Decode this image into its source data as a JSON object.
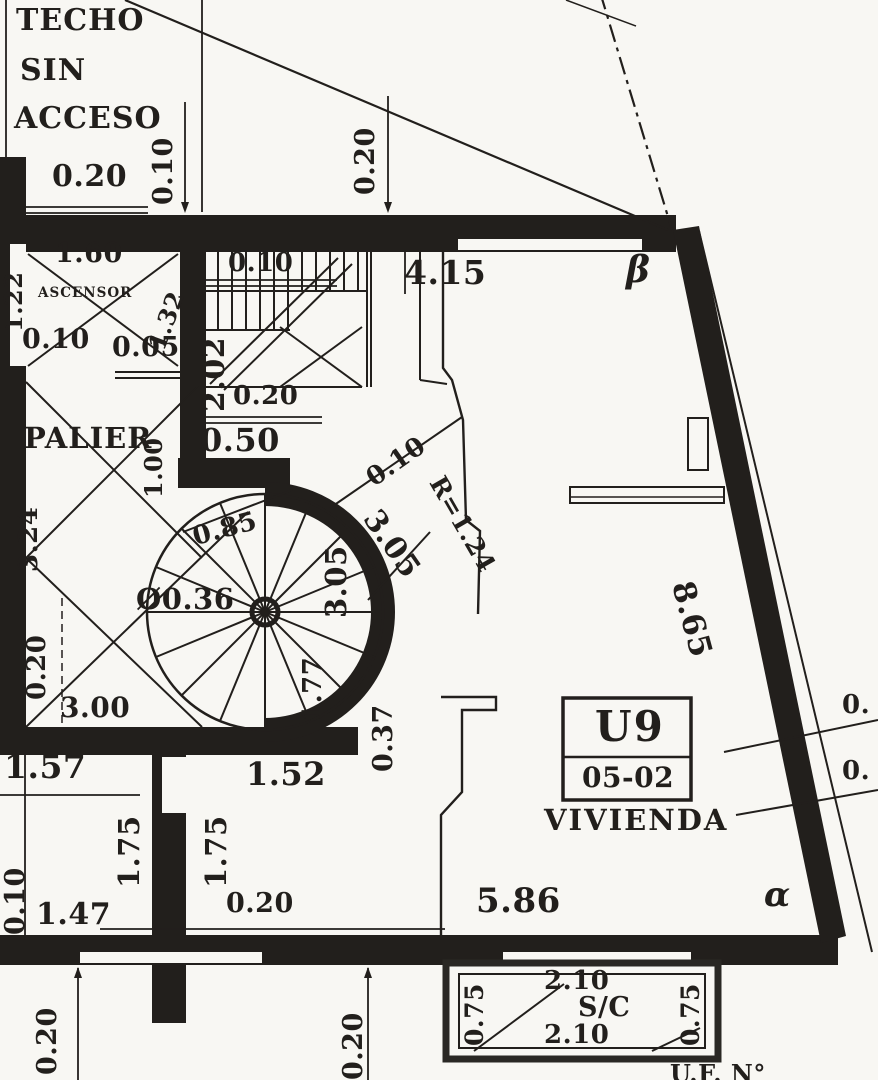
{
  "colors": {
    "ink": "#221f1c",
    "paper": "#f8f7f3"
  },
  "texts": {
    "techo_1": "TECHO",
    "techo_2": "SIN",
    "techo_3": "ACCESO",
    "ascensor": "ASCENSOR",
    "palier": "PALIER",
    "vivienda": "VIVIENDA",
    "sc": "S/C",
    "unit": "U9",
    "unit_code": "05-02",
    "alpha": "α",
    "beta": "β",
    "uf_partial": "U.F. N°"
  },
  "dims": {
    "roof_020": "0.20",
    "roof_010": "0.10",
    "top_020": "0.20",
    "top_415": "4.15",
    "elev_160": "1.60",
    "elev_122": "1.22",
    "elev_132": "1.32",
    "elev_010": "0.10",
    "elev_005": "0.05",
    "stair_202": "2.02",
    "stair_010": "0.10",
    "stair_020": "0.20",
    "stair_050": "0.50",
    "palier_100": "1.00",
    "palier_324": "3.24",
    "palier_020": "0.20",
    "palier_300": "3.00",
    "spiral_085": "0.85",
    "spiral_dia": "Ø0.36",
    "spiral_305a": "3.05",
    "spiral_305b": "3.05",
    "spiral_177": "1.77",
    "spiral_010": "0.10",
    "spiral_r": "R=1.24",
    "spiral_037": "0.37",
    "right_865": "8.65",
    "right_0a": "0.",
    "right_0b": "0.",
    "bl_157": "1.57",
    "bl_175a": "1.75",
    "bl_175b": "1.75",
    "bl_152": "1.52",
    "bot_010": "0.10",
    "bot_147": "1.47",
    "bot_020room": "0.20",
    "bot_586": "5.86",
    "bot_020a": "0.20",
    "bot_020b": "0.20",
    "balc_210a": "2.10",
    "balc_210b": "2.10",
    "balc_075a": "0.75",
    "balc_075b": "0.75"
  }
}
